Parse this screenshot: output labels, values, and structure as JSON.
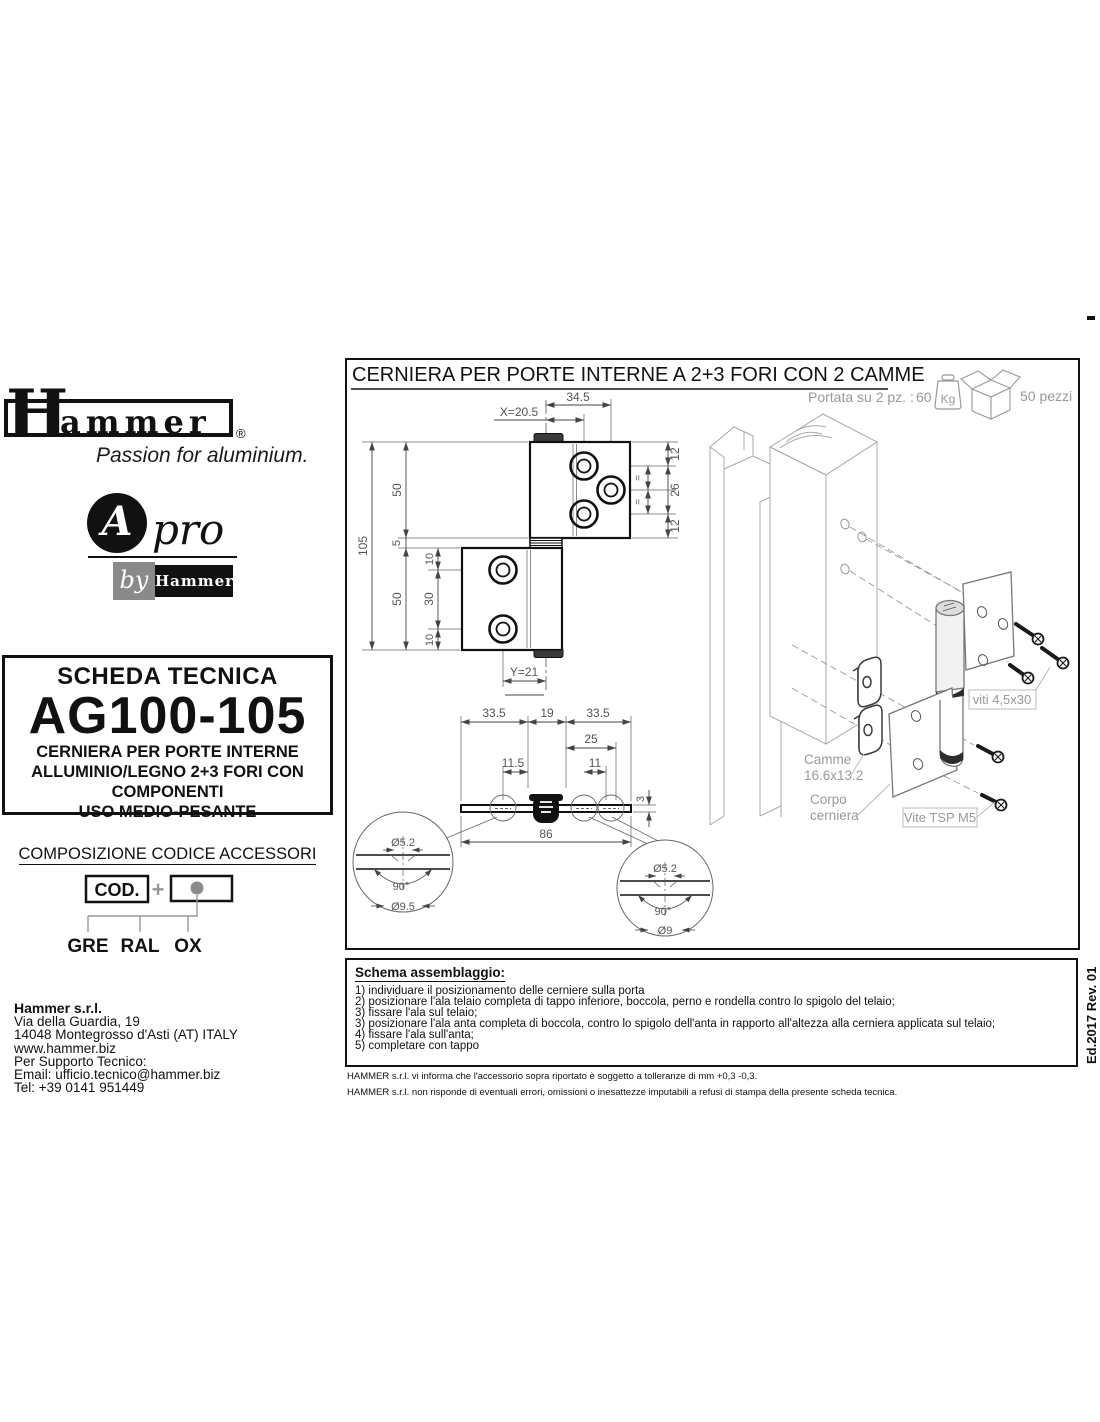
{
  "edition": "Ed.2017 Rev. 01",
  "brand": {
    "name_h": "H",
    "name_rest": "ammer",
    "registered": "®",
    "tagline": "Passion for aluminium.",
    "apro_a": "A",
    "apro_pro": "pro",
    "apro_by": "by",
    "apro_hammer": "Hammer"
  },
  "tech_sheet": {
    "label": "SCHEDA TECNICA",
    "code": "AG100-105",
    "desc": [
      "CERNIERA PER PORTE INTERNE",
      "ALLUMINIO/LEGNO 2+3 FORI CON",
      "COMPONENTI",
      "USO MEDIO-PESANTE"
    ]
  },
  "code_composition": {
    "title": "COMPOSIZIONE CODICE ACCESSORI",
    "cod": "COD.",
    "plus": "+",
    "options": [
      "GRE",
      "RAL",
      "OX"
    ]
  },
  "company": {
    "name": "Hammer s.r.l.",
    "lines": [
      "Via della Guardia, 19",
      "14048 Montegrosso d'Asti (AT) ITALY",
      "www.hammer.biz",
      "Per Supporto Tecnico:",
      "Email: ufficio.tecnico@hammer.biz",
      "Tel: +39 0141 951449"
    ]
  },
  "drawing": {
    "title": "CERNIERA PER PORTE INTERNE A 2+3 FORI CON 2 CAMME",
    "capacity_label": "Portata su 2 pz. :",
    "capacity_value": "60",
    "capacity_unit": "Kg",
    "pack_qty": "50 pezzi",
    "dims": {
      "w345": "34.5",
      "x": "X=20.5",
      "h12a": "12",
      "eq1": "=",
      "h26": "26",
      "eq2": "=",
      "h12b": "12",
      "h105": "105",
      "h50a": "50",
      "h5": "5",
      "h50b": "50",
      "v10a": "10",
      "v30": "30",
      "v10b": "10",
      "y": "Y=21",
      "b335a": "33.5",
      "b19": "19",
      "b335b": "33.5",
      "b25": "25",
      "b115": "11.5",
      "b11": "11",
      "t3": "3",
      "w86": "86",
      "dl52": "Ø5.2",
      "al90": "90°",
      "dl95": "Ø9.5",
      "dr52": "Ø5.2",
      "ar90": "90°",
      "dr9": "Ø9"
    },
    "iso": {
      "viti": "viti 4,5x30",
      "camme1": "Camme",
      "camme2": "16.6x13.2",
      "corpo1": "Corpo",
      "corpo2": "cerniera",
      "vite": "Vite TSP M5"
    }
  },
  "assembly": {
    "title": "Schema assemblaggio:",
    "steps": [
      "1) individuare il posizionamento delle cerniere sulla porta",
      "2) posizionare l'ala telaio completa di tappo inferiore, boccola, perno e rondella contro lo spigolo del telaio;",
      "3) fissare l'ala sul telaio;",
      "3) posizionare l'ala anta completa di boccola, contro lo spigolo dell'anta in rapporto all'altezza alla cerniera applicata sul telaio;",
      "4) fissare l'ala sull'anta;",
      "5) completare con tappo"
    ]
  },
  "notes": [
    "HAMMER s.r.l. vi informa che l'accessorio sopra riportato è soggetto a tolleranze di mm +0,3 -0,3.",
    "HAMMER s.r.l. non risponde di eventuali errori, omissioni o inesattezze imputabili a refusi di stampa della presente scheda tecnica."
  ]
}
